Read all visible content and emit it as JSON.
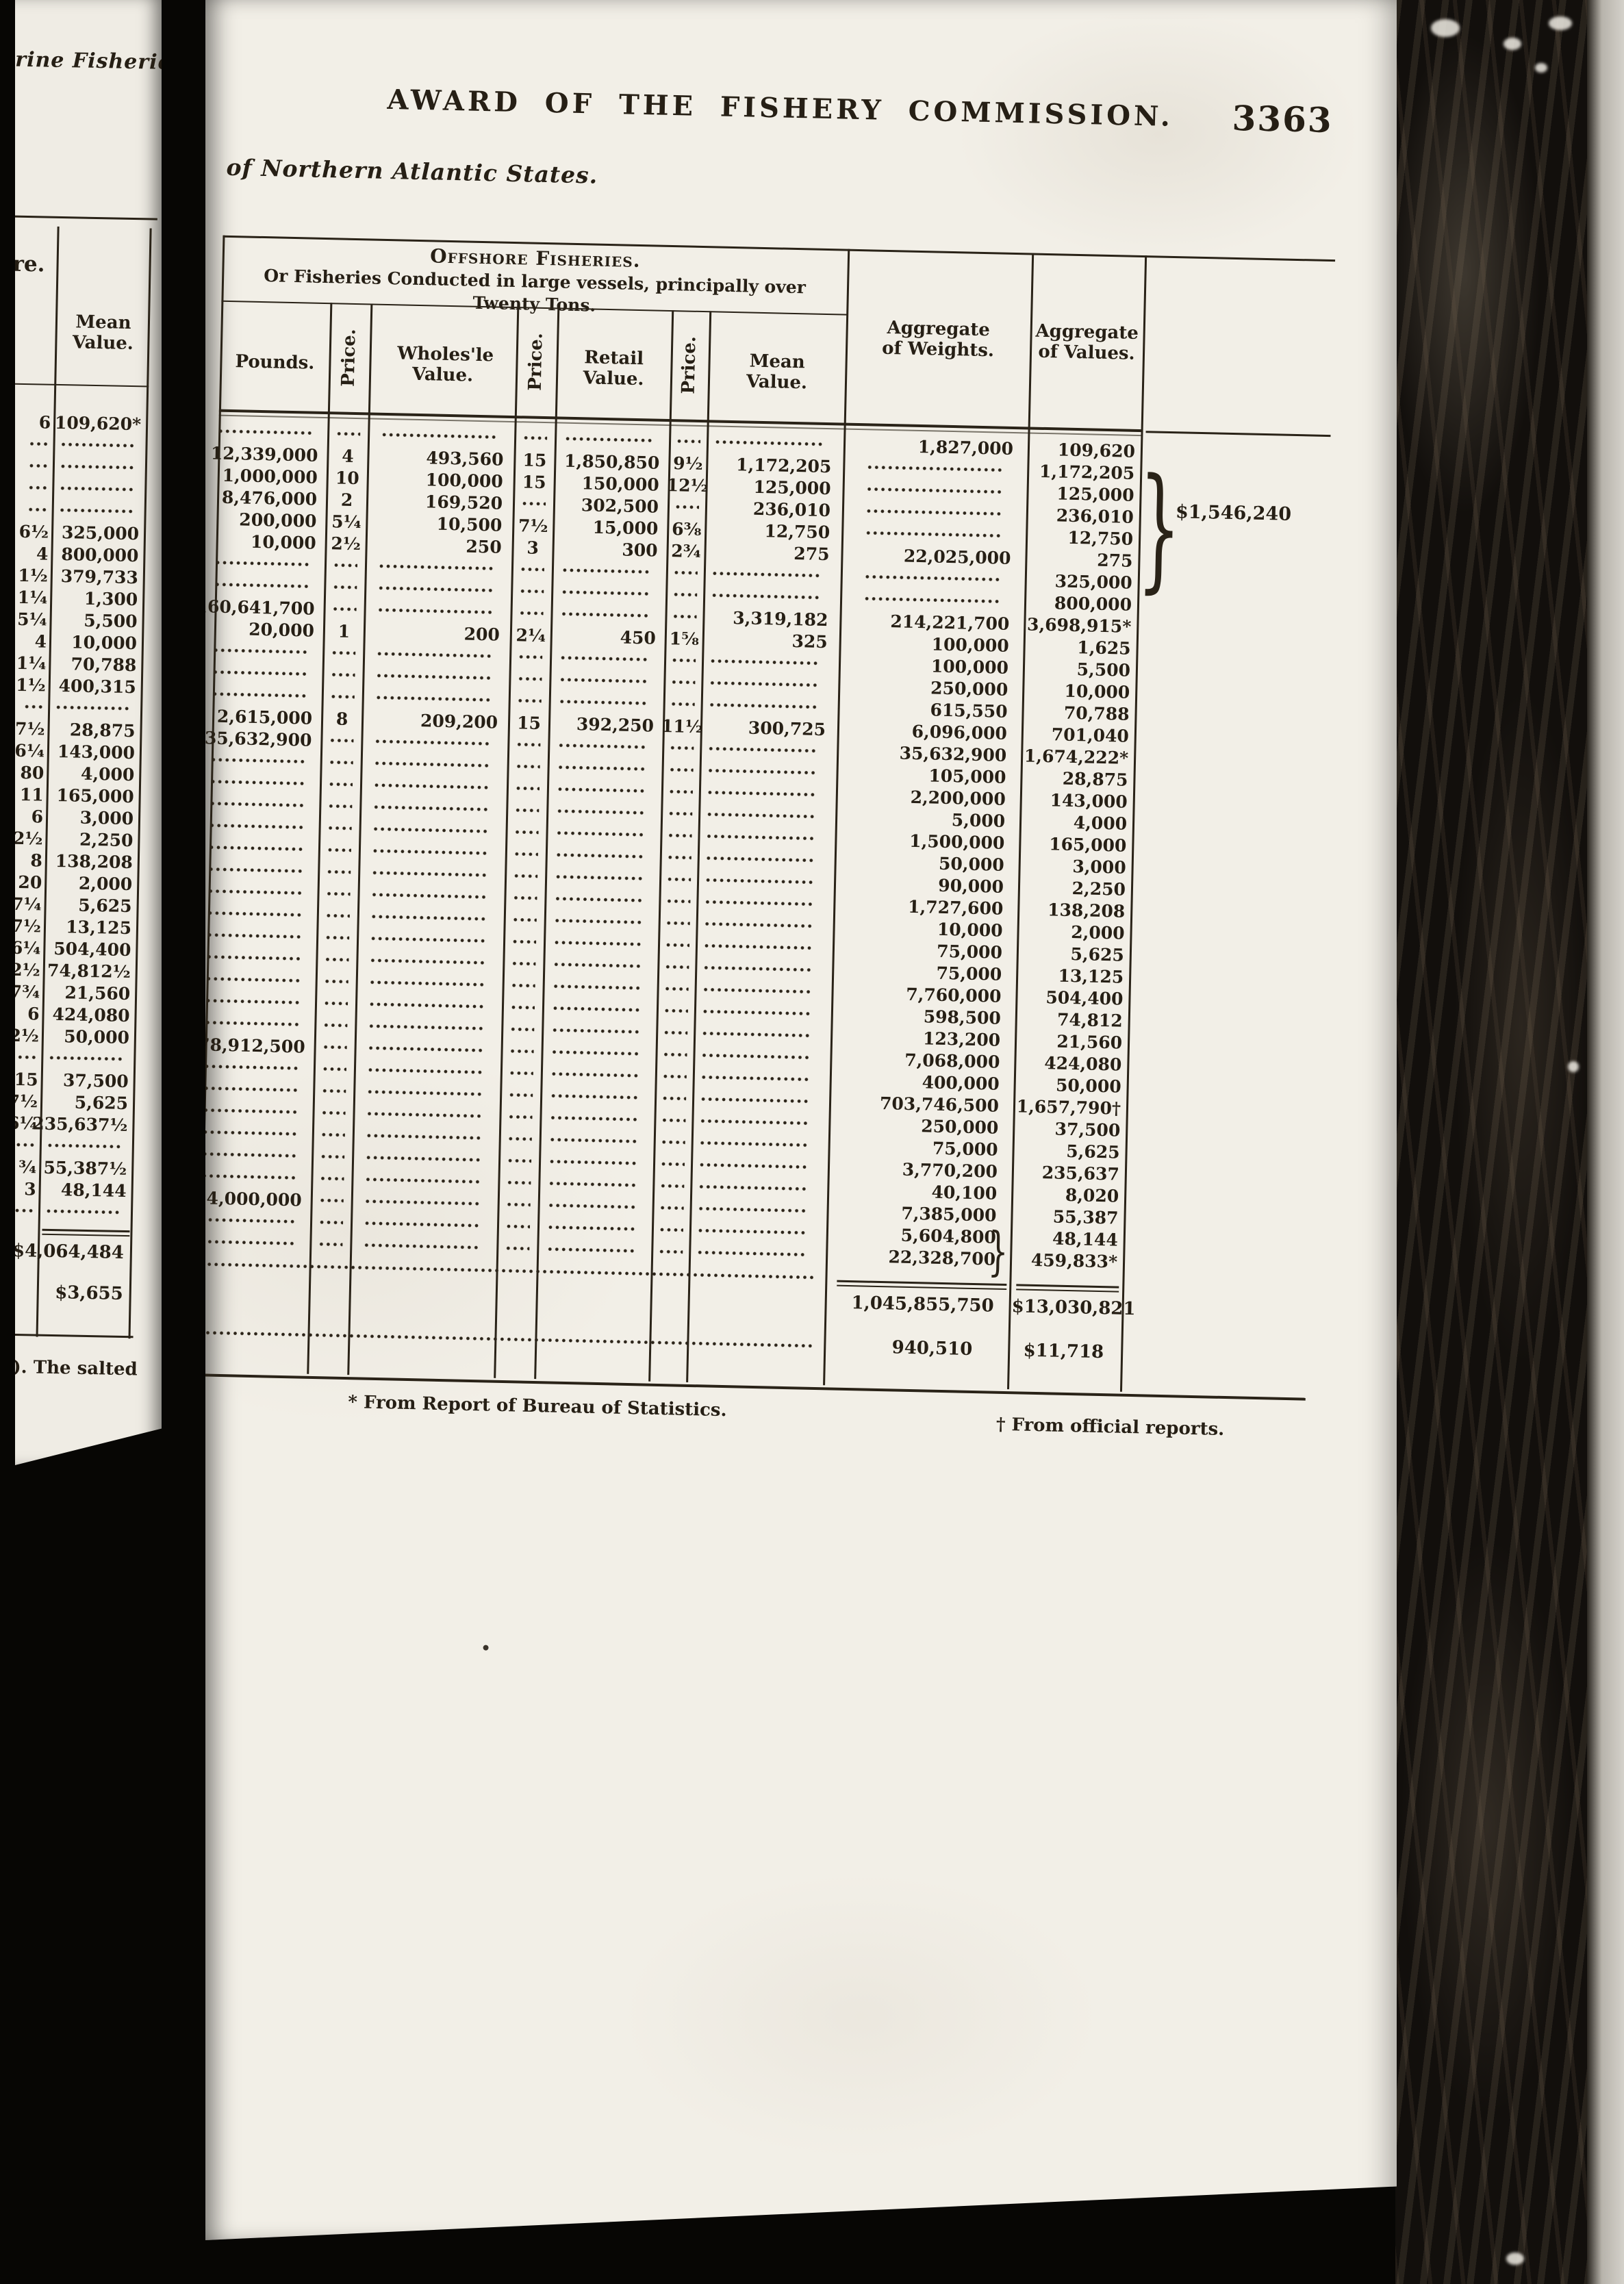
{
  "header": {
    "title": "AWARD OF THE FISHERY COMMISSION.",
    "page_number": "3363",
    "subtitle": "of Northern Atlantic States."
  },
  "offshore_table": {
    "group_header_line1": "Offshore Fisheries.",
    "group_header_line2": "Or Fisheries Conducted in large vessels, principally over",
    "group_header_line3": "Twenty Tons.",
    "col_pounds": "Pounds.",
    "col_price1": "Price.",
    "col_wholesale": "Wholes'le Value.",
    "col_price2": "Price.",
    "col_retail": "Retail Value.",
    "col_price3": "Price.",
    "col_mean": "Mean Value.",
    "col_agg_weights": "Aggregate of Weights.",
    "col_agg_values": "Aggregate of Values.",
    "rows": [
      [
        "",
        "",
        "",
        "",
        "",
        "",
        "",
        "1,827,000",
        "109,620"
      ],
      [
        "12,339,000",
        "4",
        "493,560",
        "15",
        "1,850,850",
        "9½",
        "1,172,205",
        "",
        "1,172,205"
      ],
      [
        "1,000,000",
        "10",
        "100,000",
        "15",
        "150,000",
        "12½",
        "125,000",
        "",
        "125,000"
      ],
      [
        "8,476,000",
        "2",
        "169,520",
        "",
        "302,500",
        "",
        "236,010",
        "",
        "236,010"
      ],
      [
        "200,000",
        "5¼",
        "10,500",
        "7½",
        "15,000",
        "6⅜",
        "12,750",
        "",
        "12,750"
      ],
      [
        "10,000",
        "2½",
        "250",
        "3",
        "300",
        "2¾",
        "275",
        "22,025,000",
        "275"
      ],
      [
        "",
        "",
        "",
        "",
        "",
        "",
        "",
        "",
        "325,000"
      ],
      [
        "",
        "",
        "",
        "",
        "",
        "",
        "",
        "",
        "800,000"
      ],
      [
        "160,641,700",
        "",
        "",
        "",
        "",
        "",
        "3,319,182",
        "214,221,700",
        "3,698,915*"
      ],
      [
        "20,000",
        "1",
        "200",
        "2¼",
        "450",
        "1⅝",
        "325",
        "100,000",
        "1,625"
      ],
      [
        "",
        "",
        "",
        "",
        "",
        "",
        "",
        "100,000",
        "5,500"
      ],
      [
        "",
        "",
        "",
        "",
        "",
        "",
        "",
        "250,000",
        "10,000"
      ],
      [
        "",
        "",
        "",
        "",
        "",
        "",
        "",
        "615,550",
        "70,788"
      ],
      [
        "2,615,000",
        "8",
        "209,200",
        "15",
        "392,250",
        "11½",
        "300,725",
        "6,096,000",
        "701,040"
      ],
      [
        "35,632,900",
        "",
        "",
        "",
        "",
        "",
        "",
        "35,632,900",
        "1,674,222*"
      ],
      [
        "",
        "",
        "",
        "",
        "",
        "",
        "",
        "105,000",
        "28,875"
      ],
      [
        "",
        "",
        "",
        "",
        "",
        "",
        "",
        "2,200,000",
        "143,000"
      ],
      [
        "",
        "",
        "",
        "",
        "",
        "",
        "",
        "5,000",
        "4,000"
      ],
      [
        "",
        "",
        "",
        "",
        "",
        "",
        "",
        "1,500,000",
        "165,000"
      ],
      [
        "",
        "",
        "",
        "",
        "",
        "",
        "",
        "50,000",
        "3,000"
      ],
      [
        "",
        "",
        "",
        "",
        "",
        "",
        "",
        "90,000",
        "2,250"
      ],
      [
        "",
        "",
        "",
        "",
        "",
        "",
        "",
        "1,727,600",
        "138,208"
      ],
      [
        "",
        "",
        "",
        "",
        "",
        "",
        "",
        "10,000",
        "2,000"
      ],
      [
        "",
        "",
        "",
        "",
        "",
        "",
        "",
        "75,000",
        "5,625"
      ],
      [
        "",
        "",
        "",
        "",
        "",
        "",
        "",
        "75,000",
        "13,125"
      ],
      [
        "",
        "",
        "",
        "",
        "",
        "",
        "",
        "7,760,000",
        "504,400"
      ],
      [
        "",
        "",
        "",
        "",
        "",
        "",
        "",
        "598,500",
        "74,812"
      ],
      [
        "",
        "",
        "",
        "",
        "",
        "",
        "",
        "123,200",
        "21,560"
      ],
      [
        "678,912,500",
        "",
        "",
        "",
        "",
        "",
        "",
        "7,068,000",
        "424,080"
      ],
      [
        "",
        "",
        "",
        "",
        "",
        "",
        "",
        "400,000",
        "50,000"
      ],
      [
        "",
        "",
        "",
        "",
        "",
        "",
        "",
        "703,746,500",
        "1,657,790†"
      ],
      [
        "",
        "",
        "",
        "",
        "",
        "",
        "",
        "250,000",
        "37,500"
      ],
      [
        "",
        "",
        "",
        "",
        "",
        "",
        "",
        "75,000",
        "5,625"
      ],
      [
        "",
        "",
        "",
        "",
        "",
        "",
        "",
        "3,770,200",
        "235,637"
      ],
      [
        "",
        "",
        "",
        "",
        "",
        "",
        "",
        "40,100",
        "8,020"
      ],
      [
        "4,000,000",
        "",
        "",
        "",
        "",
        "",
        "",
        "7,385,000",
        "55,387"
      ],
      [
        "",
        "",
        "",
        "",
        "",
        "",
        "",
        "5,604,800",
        "48,144"
      ],
      [
        "",
        "",
        "",
        "",
        "",
        "",
        "",
        "22,328,700",
        "459,833*"
      ]
    ],
    "values_brace_total": "$1,546,240",
    "totals": {
      "weights": "1,045,855,750",
      "values": "$13,030,821"
    },
    "addendum": {
      "weights": "940,510",
      "values": "$11,718"
    },
    "footnote_left": "* From Report of Bureau of Statistics.",
    "footnote_right": "† From official reports."
  },
  "left_fragment": {
    "top_text": "rine Fisheries",
    "mid_text": "re.",
    "col_mean_header": "Mean Value.",
    "rows": [
      [
        "6",
        "109,620*"
      ],
      [
        "",
        ""
      ],
      [
        "",
        ""
      ],
      [
        "",
        ""
      ],
      [
        "",
        ""
      ],
      [
        "6½",
        "325,000"
      ],
      [
        "4",
        "800,000"
      ],
      [
        "1½",
        "379,733"
      ],
      [
        "1¼",
        "1,300"
      ],
      [
        "5¼",
        "5,500"
      ],
      [
        "4",
        "10,000"
      ],
      [
        "11¼",
        "70,788"
      ],
      [
        "11½",
        "400,315"
      ],
      [
        "",
        ""
      ],
      [
        "27½",
        "28,875"
      ],
      [
        "6¼",
        "143,000"
      ],
      [
        "80",
        "4,000"
      ],
      [
        "11",
        "165,000"
      ],
      [
        "6",
        "3,000"
      ],
      [
        "2½",
        "2,250"
      ],
      [
        "8",
        "138,208"
      ],
      [
        "20",
        "2,000"
      ],
      [
        "7¼",
        "5,625"
      ],
      [
        "17½",
        "13,125"
      ],
      [
        "6¼",
        "504,400"
      ],
      [
        "12½",
        "74,812½"
      ],
      [
        "17¾",
        "21,560"
      ],
      [
        "6",
        "424,080"
      ],
      [
        "12½",
        "50,000"
      ],
      [
        "",
        ""
      ],
      [
        "15",
        "37,500"
      ],
      [
        "7½",
        "5,625"
      ],
      [
        "6¼",
        "235,637½"
      ],
      [
        "",
        ""
      ],
      [
        "¾",
        "55,387½"
      ],
      [
        "3",
        "48,144"
      ],
      [
        "",
        ""
      ]
    ],
    "total": "$4,064,484",
    "addendum": "$3,655",
    "bottom_text": "ch).  The salted"
  },
  "colors": {
    "page_bg": "#f2efe7",
    "ink": "#261f15",
    "film_black": "#070604",
    "fore_edge_light": "#d4d1ca"
  }
}
